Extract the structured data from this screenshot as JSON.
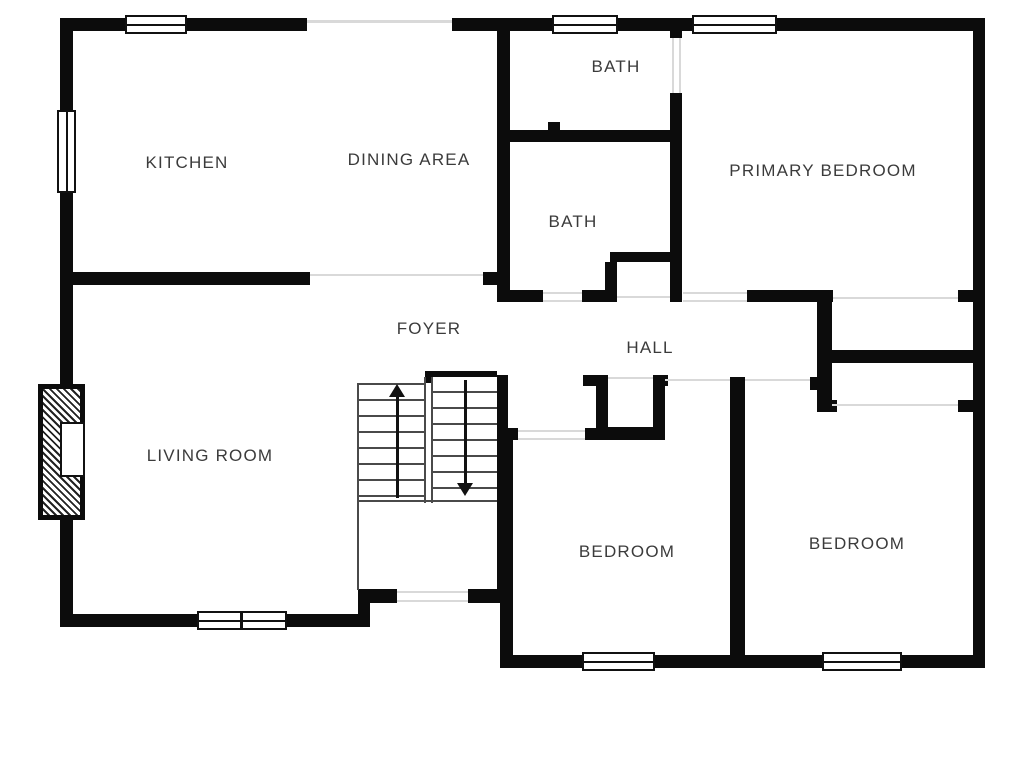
{
  "plan": {
    "colors": {
      "wall": "#0c0c0c",
      "opening_line": "#d9d9d9",
      "stair_line": "#4a4a4a",
      "label_text": "#3b3b3b",
      "background": "#ffffff"
    },
    "rooms": [
      {
        "id": "kitchen",
        "label": "KITCHEN",
        "x": 187,
        "y": 163
      },
      {
        "id": "dining-area",
        "label": "DINING AREA",
        "x": 409,
        "y": 160
      },
      {
        "id": "bath-upper",
        "label": "BATH",
        "x": 616,
        "y": 67
      },
      {
        "id": "bath-lower",
        "label": "BATH",
        "x": 573,
        "y": 222
      },
      {
        "id": "primary-bedroom",
        "label": "PRIMARY BEDROOM",
        "x": 823,
        "y": 171
      },
      {
        "id": "foyer",
        "label": "FOYER",
        "x": 429,
        "y": 329
      },
      {
        "id": "hall",
        "label": "HALL",
        "x": 650,
        "y": 348
      },
      {
        "id": "living-room",
        "label": "LIVING ROOM",
        "x": 210,
        "y": 456
      },
      {
        "id": "bedroom-left",
        "label": "BEDROOM",
        "x": 627,
        "y": 552
      },
      {
        "id": "bedroom-right",
        "label": "BEDROOM",
        "x": 857,
        "y": 544
      }
    ],
    "walls": [
      [
        60,
        18,
        65,
        13
      ],
      [
        187,
        18,
        120,
        13
      ],
      [
        452,
        18,
        100,
        13
      ],
      [
        618,
        18,
        74,
        13
      ],
      [
        777,
        18,
        208,
        13
      ],
      [
        60,
        18,
        13,
        92
      ],
      [
        60,
        193,
        13,
        191
      ],
      [
        60,
        520,
        13,
        107
      ],
      [
        973,
        18,
        12,
        650
      ],
      [
        60,
        614,
        137,
        13
      ],
      [
        287,
        614,
        83,
        13
      ],
      [
        358,
        589,
        12,
        38
      ],
      [
        358,
        589,
        39,
        14
      ],
      [
        468,
        589,
        45,
        14
      ],
      [
        500,
        655,
        82,
        13
      ],
      [
        655,
        655,
        167,
        13
      ],
      [
        902,
        655,
        83,
        13
      ],
      [
        60,
        272,
        250,
        13
      ],
      [
        483,
        272,
        27,
        13
      ],
      [
        497,
        30,
        13,
        272
      ],
      [
        500,
        130,
        182,
        12
      ],
      [
        548,
        122,
        12,
        8
      ],
      [
        670,
        31,
        12,
        7
      ],
      [
        670,
        93,
        12,
        49
      ],
      [
        670,
        142,
        12,
        120
      ],
      [
        610,
        252,
        72,
        10
      ],
      [
        605,
        262,
        12,
        40
      ],
      [
        670,
        262,
        12,
        40
      ],
      [
        500,
        290,
        43,
        12
      ],
      [
        582,
        290,
        28,
        12
      ],
      [
        747,
        290,
        86,
        12
      ],
      [
        958,
        290,
        15,
        12
      ],
      [
        817,
        295,
        15,
        117
      ],
      [
        817,
        350,
        160,
        13
      ],
      [
        817,
        400,
        20,
        12
      ],
      [
        958,
        400,
        15,
        12
      ],
      [
        810,
        377,
        7,
        13
      ],
      [
        730,
        377,
        15,
        278
      ],
      [
        497,
        428,
        21,
        12
      ],
      [
        585,
        428,
        80,
        12
      ],
      [
        583,
        375,
        13,
        11
      ],
      [
        653,
        375,
        15,
        11
      ],
      [
        596,
        375,
        12,
        62
      ],
      [
        653,
        385,
        12,
        52
      ],
      [
        596,
        427,
        69,
        10
      ],
      [
        500,
        428,
        13,
        227
      ],
      [
        425,
        371,
        72,
        12
      ],
      [
        497,
        375,
        11,
        228
      ]
    ],
    "windows": [
      {
        "x": 125,
        "y": 15,
        "w": 62,
        "h": 19,
        "orient": "h",
        "split": false
      },
      {
        "x": 552,
        "y": 15,
        "w": 66,
        "h": 19,
        "orient": "h",
        "split": false
      },
      {
        "x": 692,
        "y": 15,
        "w": 85,
        "h": 19,
        "orient": "h",
        "split": false
      },
      {
        "x": 57,
        "y": 110,
        "w": 19,
        "h": 83,
        "orient": "v",
        "split": false
      },
      {
        "x": 197,
        "y": 611,
        "w": 90,
        "h": 19,
        "orient": "h",
        "split": true
      },
      {
        "x": 582,
        "y": 652,
        "w": 73,
        "h": 19,
        "orient": "h",
        "split": false
      },
      {
        "x": 822,
        "y": 652,
        "w": 80,
        "h": 19,
        "orient": "h",
        "split": false
      }
    ],
    "opening_lines": [
      [
        310,
        274,
        173,
        2
      ],
      [
        543,
        292,
        39,
        2
      ],
      [
        543,
        300,
        39,
        2
      ],
      [
        683,
        292,
        64,
        2
      ],
      [
        683,
        300,
        64,
        2
      ],
      [
        617,
        296,
        53,
        2
      ],
      [
        833,
        297,
        125,
        2
      ],
      [
        832,
        404,
        126,
        2
      ],
      [
        745,
        379,
        65,
        2
      ],
      [
        665,
        379,
        65,
        2
      ],
      [
        608,
        377,
        45,
        2
      ],
      [
        518,
        430,
        67,
        2
      ],
      [
        518,
        438,
        67,
        2
      ],
      [
        397,
        591,
        71,
        2
      ],
      [
        397,
        600,
        71,
        2
      ],
      [
        672,
        38,
        2,
        55
      ],
      [
        679,
        38,
        2,
        55
      ]
    ],
    "glass_band": [
      307,
      20,
      145,
      3
    ],
    "stairs": {
      "thin_lines": [
        [
          357,
          383,
          2,
          207
        ],
        [
          357,
          383,
          68,
          2
        ],
        [
          424,
          377,
          2,
          126
        ],
        [
          431,
          377,
          2,
          126
        ],
        [
          359,
          500,
          138,
          2
        ]
      ],
      "runs": [
        [
          359,
          385,
          65,
          114
        ],
        [
          433,
          377,
          64,
          122
        ]
      ],
      "up_shaft": [
        396,
        395,
        3,
        103
      ],
      "down_shaft": [
        464,
        380,
        3,
        103
      ],
      "up_head": [
        389,
        384
      ],
      "down_head": [
        457,
        483
      ]
    },
    "chimney": {
      "outer": [
        38,
        384,
        47,
        136
      ],
      "firebox": [
        60,
        422,
        25,
        55
      ]
    }
  }
}
